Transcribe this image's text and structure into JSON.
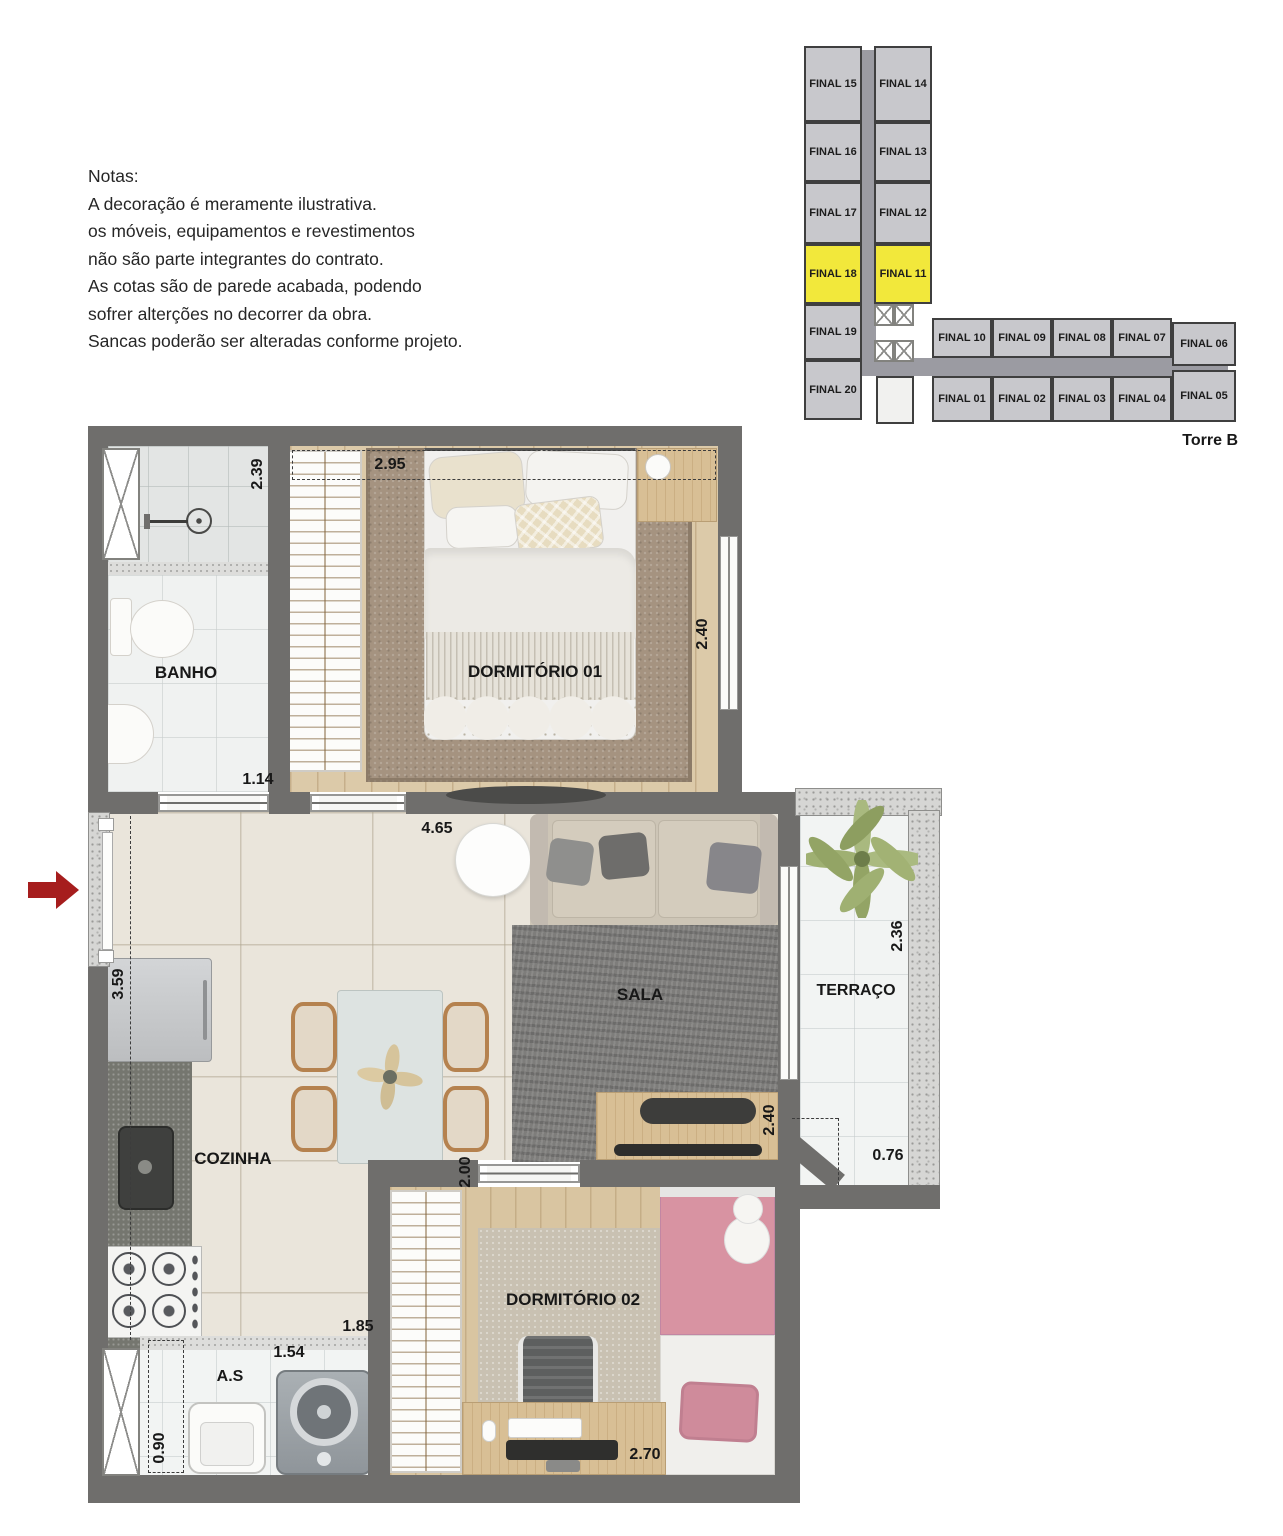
{
  "notes": {
    "title": "Notas:",
    "lines": [
      "A decoração é meramente ilustrativa.",
      "os móveis, equipamentos e revestimentos",
      "não são parte integrantes do contrato.",
      "As cotas são de parede acabada, podendo",
      "sofrer alterções no decorrer da obra.",
      "Sancas poderão ser alteradas conforme projeto."
    ]
  },
  "keyplan": {
    "tower_label": "Torre B",
    "highlight_color": "#f2e83b",
    "units": [
      {
        "label": "FINAL 15",
        "highlighted": false
      },
      {
        "label": "FINAL 14",
        "highlighted": false
      },
      {
        "label": "FINAL 16",
        "highlighted": false
      },
      {
        "label": "FINAL 13",
        "highlighted": false
      },
      {
        "label": "FINAL 17",
        "highlighted": false
      },
      {
        "label": "FINAL 12",
        "highlighted": false
      },
      {
        "label": "FINAL 18",
        "highlighted": true
      },
      {
        "label": "FINAL 11",
        "highlighted": true
      },
      {
        "label": "FINAL 19",
        "highlighted": false
      },
      {
        "label": "FINAL 20",
        "highlighted": false
      },
      {
        "label": "FINAL 10",
        "highlighted": false
      },
      {
        "label": "FINAL 09",
        "highlighted": false
      },
      {
        "label": "FINAL 08",
        "highlighted": false
      },
      {
        "label": "FINAL 07",
        "highlighted": false
      },
      {
        "label": "FINAL 06",
        "highlighted": false
      },
      {
        "label": "FINAL 01",
        "highlighted": false
      },
      {
        "label": "FINAL 02",
        "highlighted": false
      },
      {
        "label": "FINAL 03",
        "highlighted": false
      },
      {
        "label": "FINAL 04",
        "highlighted": false
      },
      {
        "label": "FINAL 05",
        "highlighted": false
      }
    ]
  },
  "plan": {
    "rooms": {
      "bathroom": "BANHO",
      "bedroom1": "DORMITÓRIO 01",
      "living": "SALA",
      "terrace": "TERRAÇO",
      "kitchen": "COZINHA",
      "bedroom2": "DORMITÓRIO 02",
      "laundry": "A.S"
    },
    "dims": {
      "banho_depth": "2.39",
      "dorm1_width": "2.95",
      "dorm1_depth": "2.40",
      "banho_width": "1.14",
      "living_width": "4.65",
      "kitchen_depth": "3.59",
      "terrace_depth": "2.36",
      "terrace_width": "0.76",
      "living_depth": "2.40",
      "closet2_depth": "2.00",
      "kitchen_width": "1.85",
      "laundry_width": "1.54",
      "laundry_depth": "0.90",
      "dorm2_width": "2.70"
    }
  },
  "colors": {
    "wall": "#6f6e6c",
    "highlight": "#f2e83b",
    "arrow": "#a61d1d"
  }
}
